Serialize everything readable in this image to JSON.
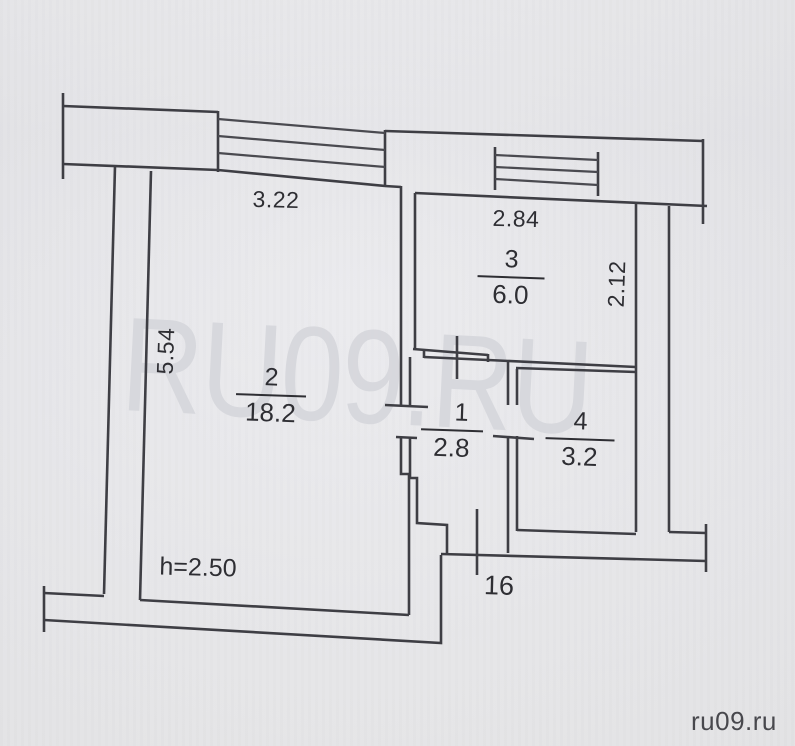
{
  "site": {
    "watermark": "RU09.RU",
    "credit": "ru09.ru"
  },
  "plan": {
    "type": "apartment-floor-plan",
    "height_note": "h=2.50",
    "unit_number": "16",
    "rooms": [
      {
        "number": "2",
        "area": "18.2"
      },
      {
        "number": "3",
        "area": "6.0"
      },
      {
        "number": "1",
        "area": "2.8"
      },
      {
        "number": "4",
        "area": "3.2"
      }
    ],
    "dimensions": {
      "top_left_width": "3.22",
      "top_right_width": "2.84",
      "left_height": "5.54",
      "right_height": "2.12"
    },
    "colors": {
      "paper": "#e5e5e9",
      "line": "#3e3e44",
      "text": "#2e2e33",
      "watermark": "#d6d7dc"
    }
  }
}
